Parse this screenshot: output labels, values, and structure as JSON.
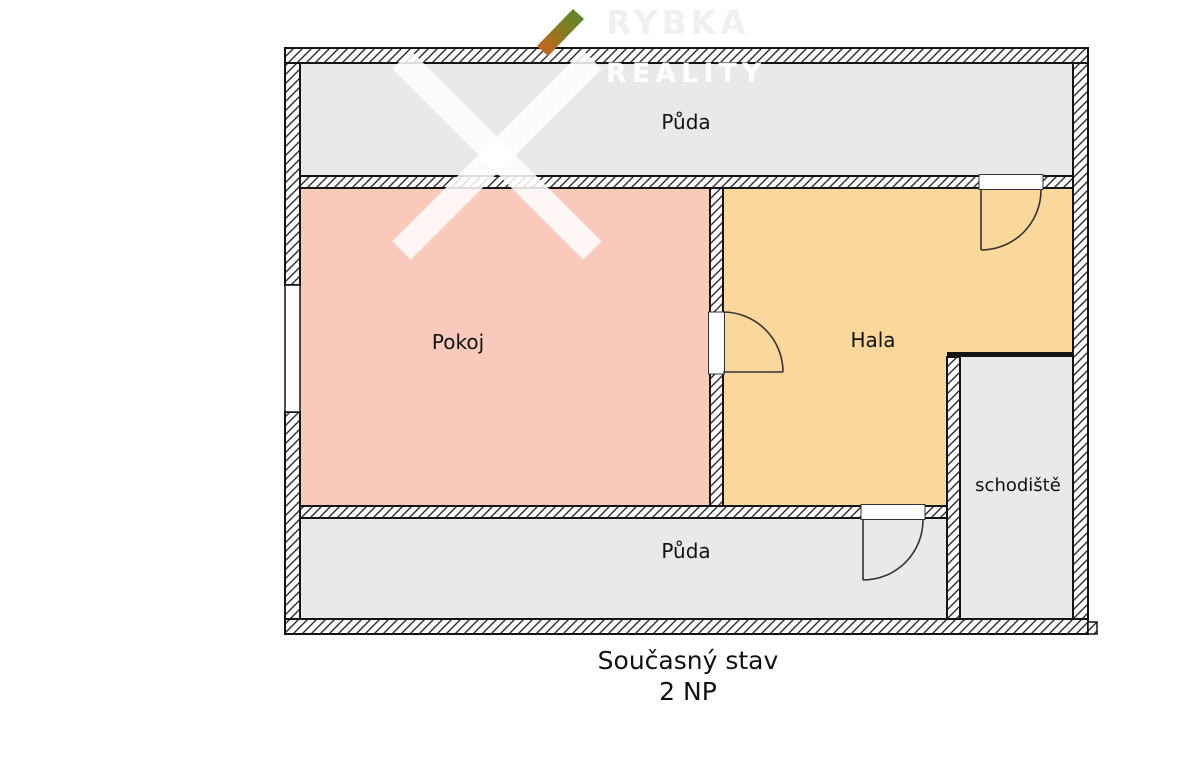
{
  "watermark": {
    "brand_line1": "RYBKA",
    "brand_line2": "REALITY"
  },
  "rooms": {
    "puda_top": {
      "label": "Půda"
    },
    "pokoj": {
      "label": "Pokoj"
    },
    "hala": {
      "label": "Hala"
    },
    "schodiste": {
      "label": "schodiště"
    },
    "puda_bottom": {
      "label": "Půda"
    }
  },
  "caption": {
    "line1": "Současný stav",
    "line2": "2 NP"
  },
  "colors": {
    "room_gray": "#e8e9e8",
    "pokoj_pink": "#f9c9bb",
    "hala_orange": "#fad79b",
    "wall_line": "#141414",
    "door_line": "#333333",
    "logo_orange": "#d95f1e",
    "logo_green": "#4f8c2a"
  }
}
